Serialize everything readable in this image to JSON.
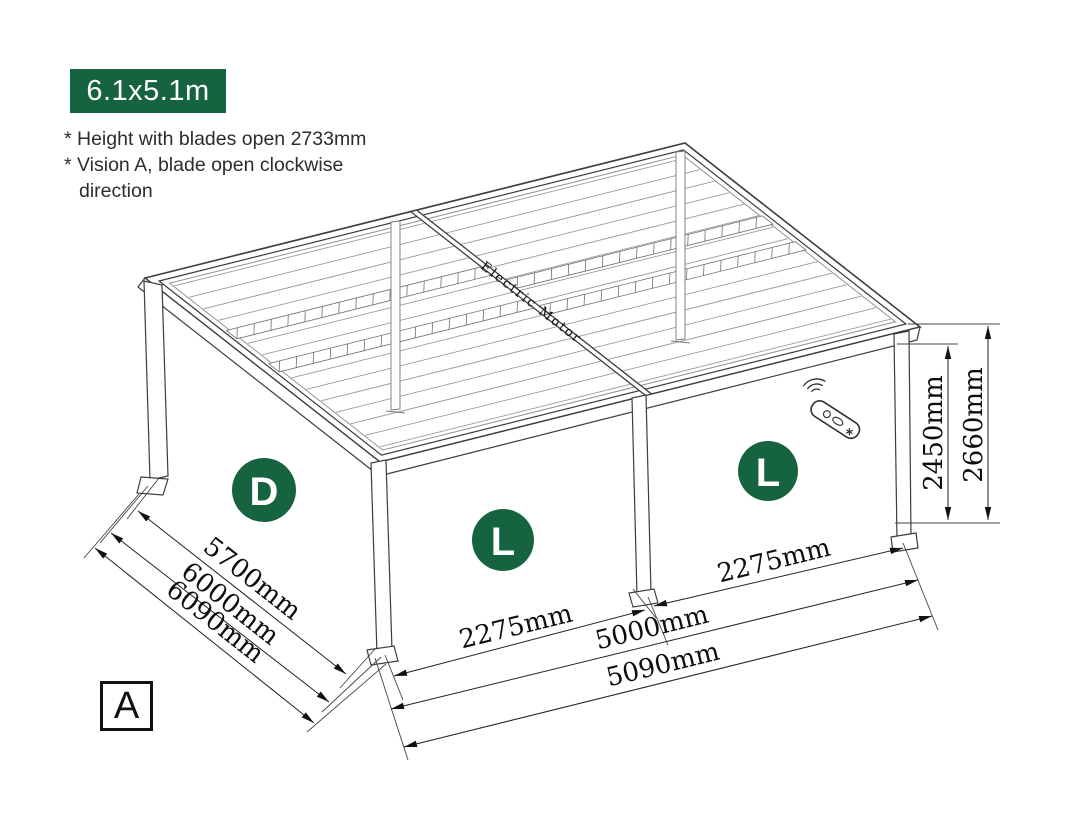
{
  "badge": {
    "label": "6.1x5.1m"
  },
  "notes": {
    "line1": "* Height with blades open 2733mm",
    "line2": "* Vision A, blade open clockwise",
    "line3": "direction"
  },
  "view_marker": "A",
  "drawing": {
    "motor_label": "Electric Motor",
    "markers": {
      "left_wall": "D",
      "front_wall": "L",
      "right_wall": "L"
    },
    "dims": {
      "d5700": "5700mm",
      "d6000": "6000mm",
      "d6090": "6090mm",
      "d2275_front": "2275mm",
      "d2275_right": "2275mm",
      "d5000": "5000mm",
      "d5090": "5090mm",
      "d2450": "2450mm",
      "d2660": "2660mm"
    },
    "colors": {
      "accent_green": "#166340",
      "line_dark": "#2f2f2f"
    }
  }
}
